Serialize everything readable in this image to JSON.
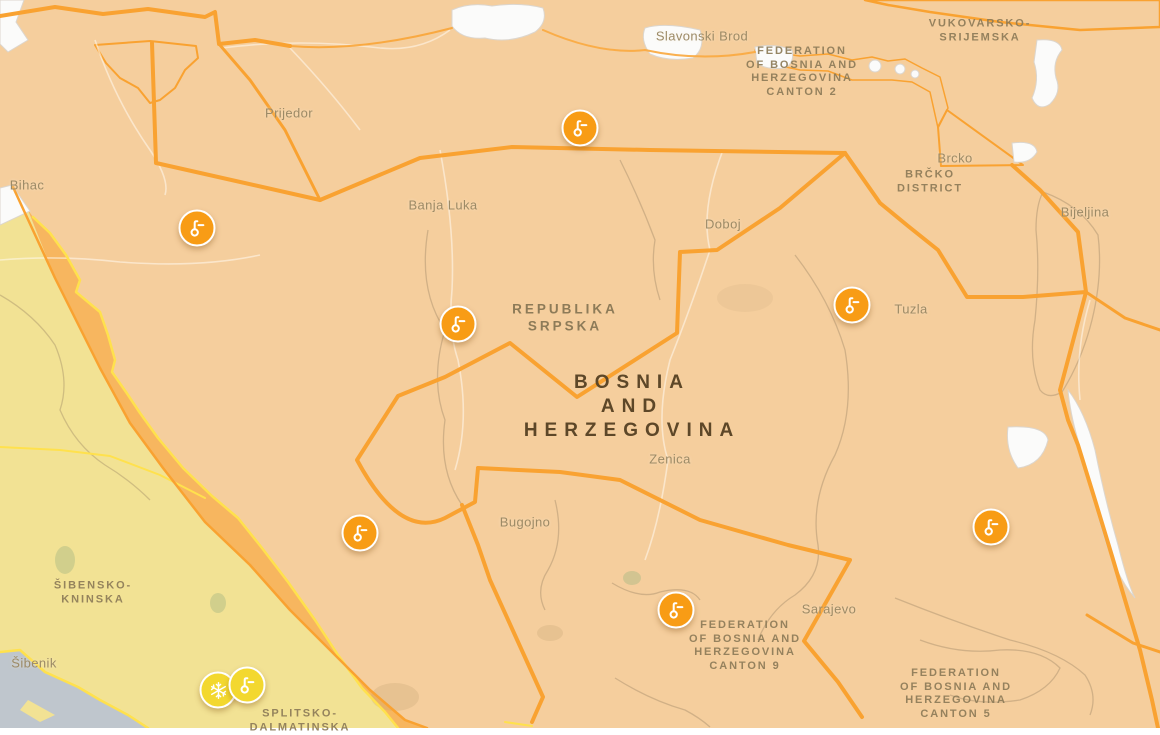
{
  "colors": {
    "warning_orange_fill": "#F5CE9D",
    "warning_orange_strong": "#F7B65F",
    "border_orange": "#F9A231",
    "icon_orange": "#F89C15",
    "warning_yellow_fill": "#F2E294",
    "border_yellow": "#FFE14D",
    "icon_yellow": "#F3D82F",
    "sea": "#BFC6CD",
    "no_warning": "#FBFBFA",
    "city_label": "#9C8A66",
    "region_label": "#8D7B58",
    "country_label": "#5D4728"
  },
  "country_label": {
    "lines": [
      "BOSNIA",
      "AND",
      "HERZEGOVINA"
    ],
    "x": 632,
    "y": 407
  },
  "sub_country_label": {
    "lines": [
      "REPUBLIKA",
      "SRPSKA"
    ],
    "x": 565,
    "y": 318
  },
  "city_labels": [
    {
      "id": "slavonski-brod",
      "text": "Slavonski Brod",
      "x": 702,
      "y": 36
    },
    {
      "id": "prijedor",
      "text": "Prijedor",
      "x": 289,
      "y": 113
    },
    {
      "id": "bihac",
      "text": "Bihac",
      "x": 27,
      "y": 185
    },
    {
      "id": "brcko",
      "text": "Brcko",
      "x": 955,
      "y": 158
    },
    {
      "id": "bijeljina",
      "text": "Bijeljina",
      "x": 1085,
      "y": 212
    },
    {
      "id": "banja-luka",
      "text": "Banja Luka",
      "x": 443,
      "y": 205
    },
    {
      "id": "doboj",
      "text": "Doboj",
      "x": 723,
      "y": 224
    },
    {
      "id": "tuzla",
      "text": "Tuzla",
      "x": 911,
      "y": 309
    },
    {
      "id": "zenica",
      "text": "Zenica",
      "x": 670,
      "y": 459
    },
    {
      "id": "bugojno",
      "text": "Bugojno",
      "x": 525,
      "y": 522
    },
    {
      "id": "sarajevo",
      "text": "Sarajevo",
      "x": 829,
      "y": 609
    },
    {
      "id": "sibenik",
      "text": "Šibenik",
      "x": 34,
      "y": 663
    }
  ],
  "region_labels": [
    {
      "id": "vukovarsko-srijemska",
      "lines": [
        "VUKOVARSKO-",
        "SRIJEMSKA"
      ],
      "x": 980,
      "y": 31
    },
    {
      "id": "fbih-canton-2",
      "lines": [
        "FEDERATION",
        "OF BOSNIA AND",
        "HERZEGOVINA",
        "CANTON 2"
      ],
      "x": 802,
      "y": 72
    },
    {
      "id": "brcko-district",
      "lines": [
        "BRČKO",
        "DISTRICT"
      ],
      "x": 930,
      "y": 182
    },
    {
      "id": "sibensko-kninska",
      "lines": [
        "ŠIBENSKO-",
        "KNINSKA"
      ],
      "x": 93,
      "y": 593
    },
    {
      "id": "fbih-canton-9",
      "lines": [
        "FEDERATION",
        "OF BOSNIA AND",
        "HERZEGOVINA",
        "CANTON 9"
      ],
      "x": 745,
      "y": 646
    },
    {
      "id": "fbih-canton-5",
      "lines": [
        "FEDERATION",
        "OF BOSNIA AND",
        "HERZEGOVINA",
        "CANTON 5"
      ],
      "x": 956,
      "y": 694
    },
    {
      "id": "splitsko-dalmatinska",
      "lines": [
        "SPLITSKO-",
        "DALMATINSKA"
      ],
      "x": 300,
      "y": 721
    }
  ],
  "warning_icons": [
    {
      "name": "high-temperature-warning-icon",
      "glyph": "thermometer",
      "severity": "orange",
      "x": 580,
      "y": 128
    },
    {
      "name": "high-temperature-warning-icon",
      "glyph": "thermometer",
      "severity": "orange",
      "x": 197,
      "y": 228
    },
    {
      "name": "high-temperature-warning-icon",
      "glyph": "thermometer",
      "severity": "orange",
      "x": 458,
      "y": 324
    },
    {
      "name": "high-temperature-warning-icon",
      "glyph": "thermometer",
      "severity": "orange",
      "x": 852,
      "y": 305
    },
    {
      "name": "high-temperature-warning-icon",
      "glyph": "thermometer",
      "severity": "orange",
      "x": 360,
      "y": 533
    },
    {
      "name": "high-temperature-warning-icon",
      "glyph": "thermometer",
      "severity": "orange",
      "x": 676,
      "y": 610
    },
    {
      "name": "high-temperature-warning-icon",
      "glyph": "thermometer",
      "severity": "orange",
      "x": 991,
      "y": 527
    },
    {
      "name": "snow-ice-warning-icon",
      "glyph": "snowflake",
      "severity": "yellow",
      "x": 218,
      "y": 690
    },
    {
      "name": "low-temperature-warning-icon",
      "glyph": "thermometer",
      "severity": "yellow",
      "x": 247,
      "y": 685
    }
  ]
}
